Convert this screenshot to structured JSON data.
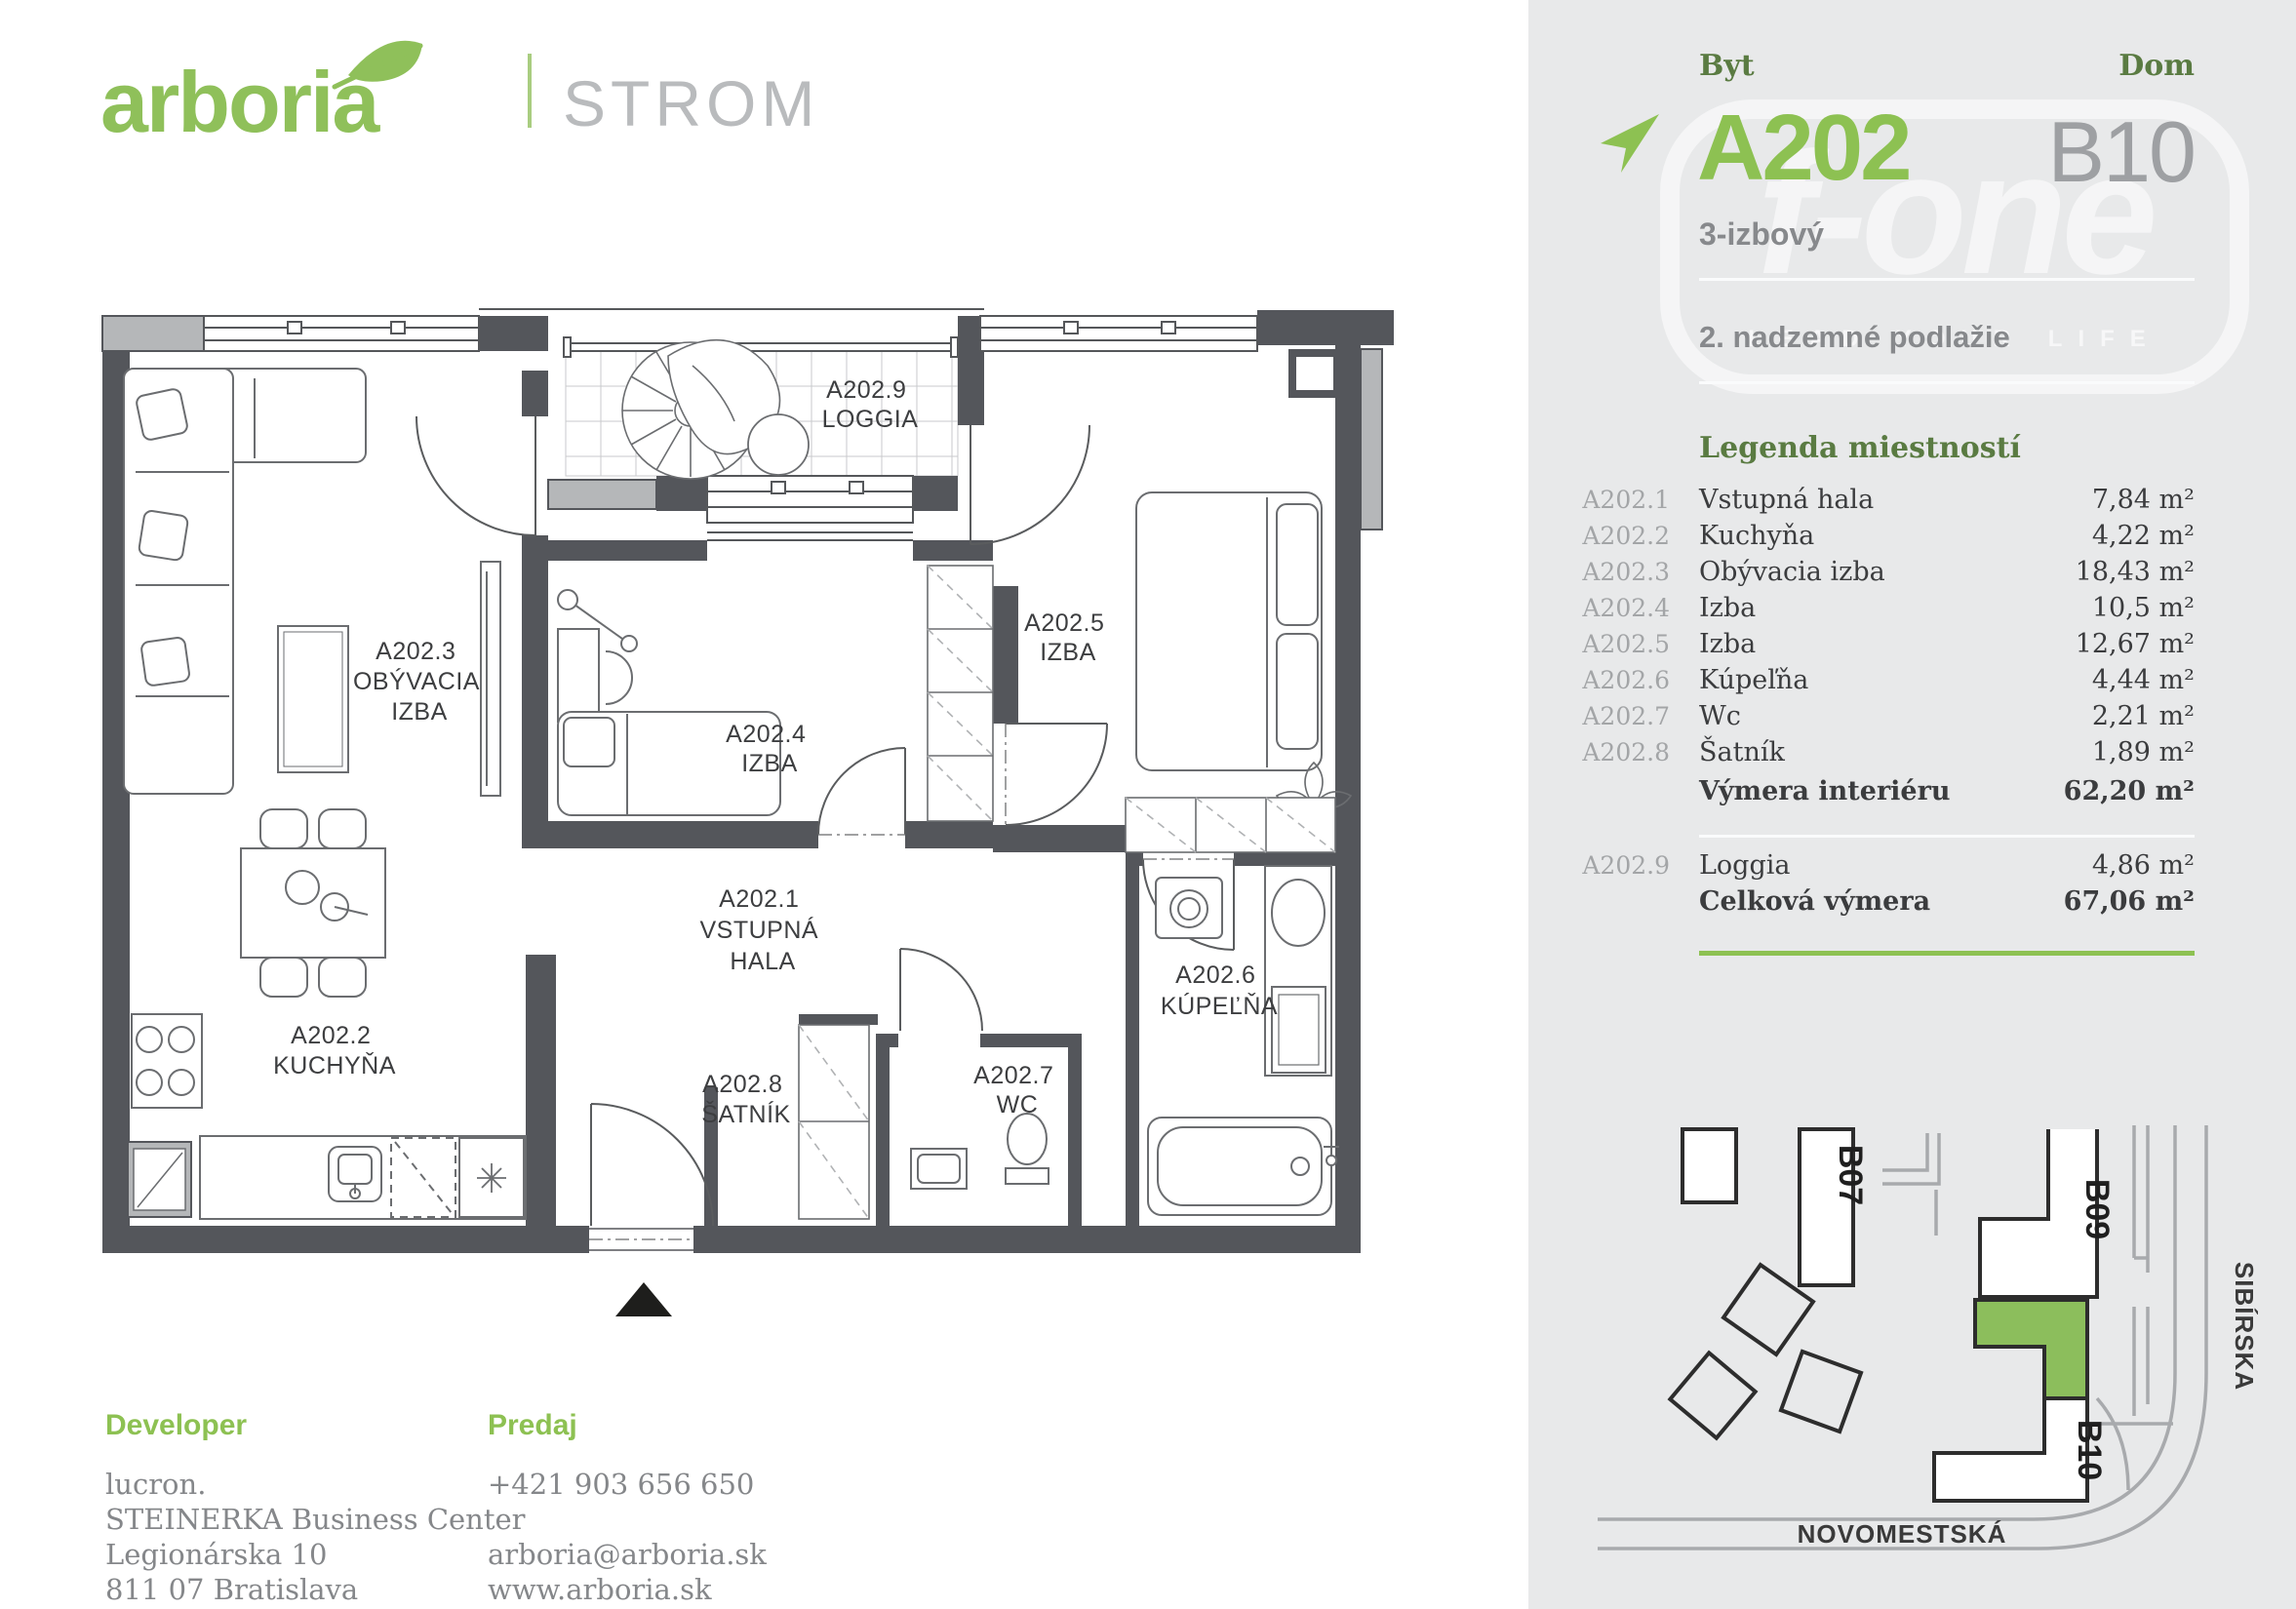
{
  "header": {
    "logo_text": "arboria",
    "project": "STROMOVÁ"
  },
  "sidebar": {
    "byt_label": "Byt",
    "dom_label": "Dom",
    "apartment_id": "A202",
    "building_id": "B10",
    "apartment_type": "3-izbový",
    "floor": "2. nadzemné podlažie",
    "watermark": {
      "brand": "f-one",
      "tagline": "LEAD YOUR LIFE"
    },
    "legend": {
      "title": "Legenda miestností",
      "rows": [
        {
          "code": "A202.1",
          "name": "Vstupná hala",
          "area": "7,84 m²"
        },
        {
          "code": "A202.2",
          "name": "Kuchyňa",
          "area": "4,22 m²"
        },
        {
          "code": "A202.3",
          "name": "Obývacia izba",
          "area": "18,43 m²"
        },
        {
          "code": "A202.4",
          "name": "Izba",
          "area": "10,5 m²"
        },
        {
          "code": "A202.5",
          "name": "Izba",
          "area": "12,67 m²"
        },
        {
          "code": "A202.6",
          "name": "Kúpeľňa",
          "area": "4,44 m²"
        },
        {
          "code": "A202.7",
          "name": "Wc",
          "area": "2,21 m²"
        },
        {
          "code": "A202.8",
          "name": "Šatník",
          "area": "1,89 m²"
        }
      ],
      "interior_total_label": "Výmera interiéru",
      "interior_total": "62,20 m²",
      "loggia_row": {
        "code": "A202.9",
        "name": "Loggia",
        "area": "4,86 m²"
      },
      "total_label": "Celková výmera",
      "total": "67,06 m²"
    },
    "sitemap": {
      "building_b07": "B07",
      "building_b09": "B09",
      "building_b10": "B10",
      "highlighted_building": "B10",
      "street_vertical": "SIBÍRSKA",
      "street_horizontal": "NOVOMESTSKÁ"
    }
  },
  "floorplan": {
    "rooms": [
      {
        "code": "A202.3",
        "lines": [
          "OBÝVACIA",
          "IZBA"
        ]
      },
      {
        "code": "A202.9",
        "lines": [
          "LOGGIA"
        ]
      },
      {
        "code": "A202.4",
        "lines": [
          "IZBA"
        ]
      },
      {
        "code": "A202.5",
        "lines": [
          "IZBA"
        ]
      },
      {
        "code": "A202.1",
        "lines": [
          "VSTUPNÁ",
          "HALA"
        ]
      },
      {
        "code": "A202.2",
        "lines": [
          "KUCHYŇA"
        ]
      },
      {
        "code": "A202.8",
        "lines": [
          "ŠATNÍK"
        ]
      },
      {
        "code": "A202.7",
        "lines": [
          "WC"
        ]
      },
      {
        "code": "A202.6",
        "lines": [
          "KÚPEĽŇA"
        ]
      }
    ]
  },
  "footer": {
    "developer_label": "Developer",
    "developer_lines": [
      "lucron.",
      "STEINERKA Business Center",
      "Legionárska 10",
      "811 07 Bratislava"
    ],
    "sales_label": "Predaj",
    "phone": "+421 903 656 650",
    "email": "arboria@arboria.sk",
    "web": "www.arboria.sk"
  },
  "colors": {
    "accent_green": "#8dc152",
    "dark_green": "#5a7b42",
    "sidebar_bg": "#e8e9ea",
    "wall_dark": "#54565b",
    "wall_light": "#b5b7b9",
    "map_green": "#8cbe5c",
    "gray_text": "#87898c"
  }
}
